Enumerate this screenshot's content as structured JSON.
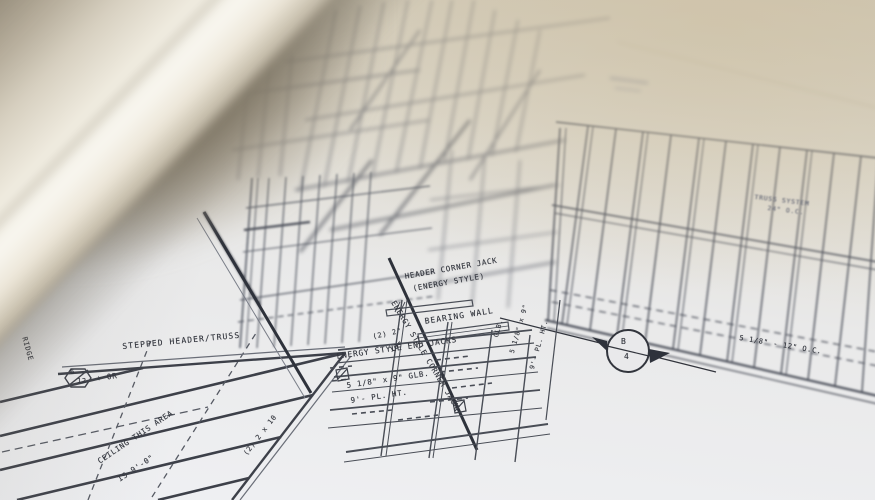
{
  "annotations": {
    "header_corner_jack_line1": "HEADER CORNER JACK",
    "header_corner_jack_line2": "(ENERGY STYLE)",
    "bearing_wall": "BEARING WALL",
    "energy_style_end_jacks": "ENERGY STYLE END JACKS",
    "energy_style_corner_jack": "ENERGY STYLE CORNER JACK",
    "stepped_header_truss": "STEPPED HEADER/TRUSS",
    "dim_two_2": "(2) 2\"",
    "dim_10": "10\"",
    "glb_beam": "5 1/8\" x 9\" GLB.",
    "plate_height": "9'- PL. HT.",
    "glb_vertical": "GLB.",
    "glb_vertical_size": "5 1/8\" x 9\"",
    "plate_height_vertical": "9'- PL. HT.",
    "beam_2x10": "(2) 2 x 10",
    "pitch_or": "+ OR",
    "ridge": "RIDGE",
    "ceiling_note_line1": "CEILING THIS AREA",
    "ceiling_note_line2": "IS 9'-0\"",
    "truss_system_line1": "TRUSS SYSTEM",
    "truss_system_line2": "24\" O.C.",
    "spacing_dim": "5 1/8\" - 12\" O.C."
  },
  "symbols": {
    "roof_pitch_rise": "6",
    "roof_pitch_run": "12",
    "section_marker_top": "B",
    "section_marker_bottom": "4"
  },
  "colors": {
    "paper_white": "#eff0f3",
    "paper_warm": "#d7d0c0",
    "table_taupe": "#8a8070",
    "ink_dark": "#33363e",
    "ink_medium": "#575b66",
    "roll_highlight": "#f8f6ef",
    "roll_shadow": "#8a8170"
  }
}
